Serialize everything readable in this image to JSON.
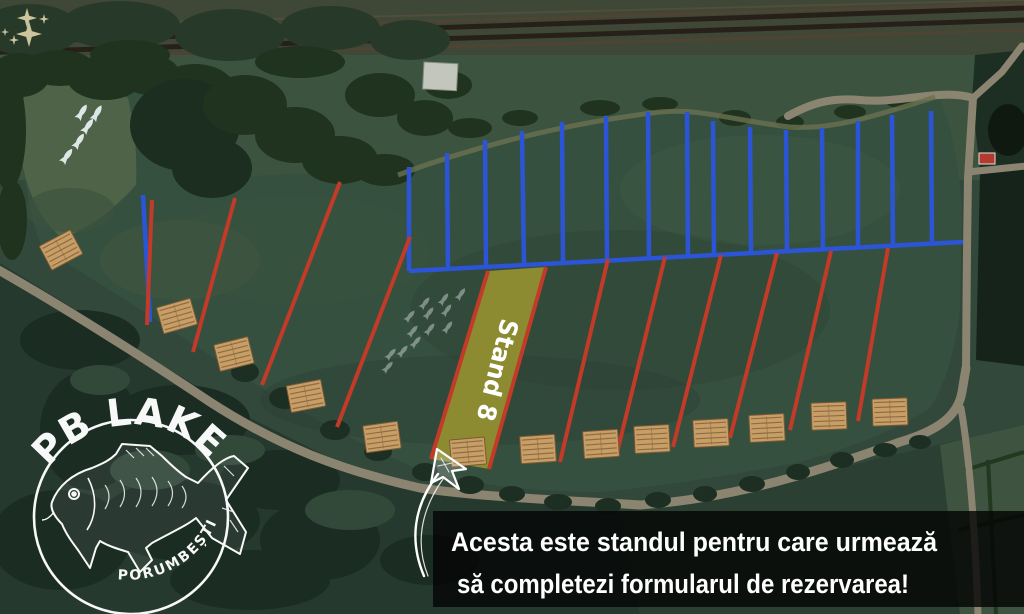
{
  "canvas": {
    "width": 1024,
    "height": 614
  },
  "overlay": {
    "line1": "Acesta este standul pentru care urmează",
    "line2": "să completezi formularul de rezervarea!"
  },
  "stand": {
    "label": "Stand 8"
  },
  "logo": {
    "title": "PB LAKE",
    "subtitle": "PORUMBEȘTI"
  },
  "colors": {
    "red_line": "#c23a28",
    "blue_line": "#2b55d6",
    "stand_fill": "#939032",
    "platform": "#c89e67",
    "platform_plank": "#84halt",
    "plank": "#85643c",
    "fish": "#e6edf1",
    "sparkle": "#d9d0a6",
    "text": "#ffffff"
  },
  "map": {
    "blue_lines": [
      [
        409,
        167,
        409,
        271
      ],
      [
        447,
        153,
        448,
        269
      ],
      [
        485,
        140,
        486,
        267
      ],
      [
        522,
        131,
        524,
        265
      ],
      [
        562,
        122,
        563,
        263
      ],
      [
        606,
        116,
        607,
        261
      ],
      [
        648,
        112,
        649,
        259
      ],
      [
        687,
        112,
        688,
        257
      ],
      [
        713,
        121,
        714,
        256
      ],
      [
        750,
        127,
        751,
        254
      ],
      [
        786,
        130,
        787,
        252
      ],
      [
        822,
        128,
        823,
        250
      ],
      [
        858,
        121,
        858,
        248
      ],
      [
        892,
        115,
        893,
        246
      ],
      [
        931,
        111,
        932,
        244
      ]
    ],
    "blue_baseline": [
      409,
      271,
      963,
      242
    ],
    "left_blue_line": [
      143,
      195,
      150,
      322
    ],
    "red_lines": [
      [
        152,
        200,
        147,
        325
      ],
      [
        235,
        198,
        193,
        352
      ],
      [
        340,
        182,
        262,
        385
      ],
      [
        410,
        237,
        337,
        427
      ],
      [
        488,
        271,
        431,
        459
      ],
      [
        546,
        267,
        489,
        469
      ],
      [
        608,
        259,
        560,
        462
      ],
      [
        665,
        257,
        617,
        453
      ],
      [
        721,
        255,
        673,
        447
      ],
      [
        777,
        253,
        730,
        438
      ],
      [
        831,
        251,
        790,
        430
      ],
      [
        888,
        248,
        858,
        421
      ]
    ],
    "stand8_polygon": "488,271 546,267 489,469 431,459",
    "stand8_label": {
      "x": 489,
      "y": 368,
      "rotate": 104,
      "font_size": 25,
      "text_length": 104
    },
    "platform_size": [
      35,
      27
    ],
    "platforms": [
      [
        61,
        250,
        -28
      ],
      [
        177,
        316,
        -16
      ],
      [
        234,
        354,
        -14
      ],
      [
        306,
        396,
        -11
      ],
      [
        382,
        437,
        -8
      ],
      [
        468,
        452,
        -5
      ],
      [
        538,
        449,
        -4
      ],
      [
        601,
        444,
        -4
      ],
      [
        652,
        439,
        -3
      ],
      [
        711,
        433,
        -3
      ],
      [
        767,
        428,
        -3
      ],
      [
        829,
        416,
        -2
      ],
      [
        890,
        412,
        -2
      ]
    ],
    "fish_school_a": [
      [
        82,
        112,
        32
      ],
      [
        97,
        113,
        30
      ],
      [
        88,
        126,
        35
      ],
      [
        79,
        141,
        33
      ],
      [
        67,
        156,
        36
      ]
    ],
    "fish_school_b": [
      [
        425,
        303,
        38
      ],
      [
        444,
        299,
        36
      ],
      [
        461,
        294,
        35
      ],
      [
        410,
        316,
        40
      ],
      [
        429,
        313,
        38
      ],
      [
        447,
        310,
        36
      ],
      [
        413,
        331,
        40
      ],
      [
        430,
        329,
        38
      ],
      [
        448,
        327,
        36
      ],
      [
        391,
        354,
        42
      ],
      [
        403,
        351,
        40
      ],
      [
        416,
        342,
        40
      ],
      [
        388,
        367,
        42
      ]
    ],
    "sparkles": [
      [
        27,
        18,
        10
      ],
      [
        29,
        34,
        13
      ],
      [
        14,
        40,
        5
      ],
      [
        44,
        19,
        5
      ],
      [
        5,
        32,
        4
      ]
    ]
  }
}
